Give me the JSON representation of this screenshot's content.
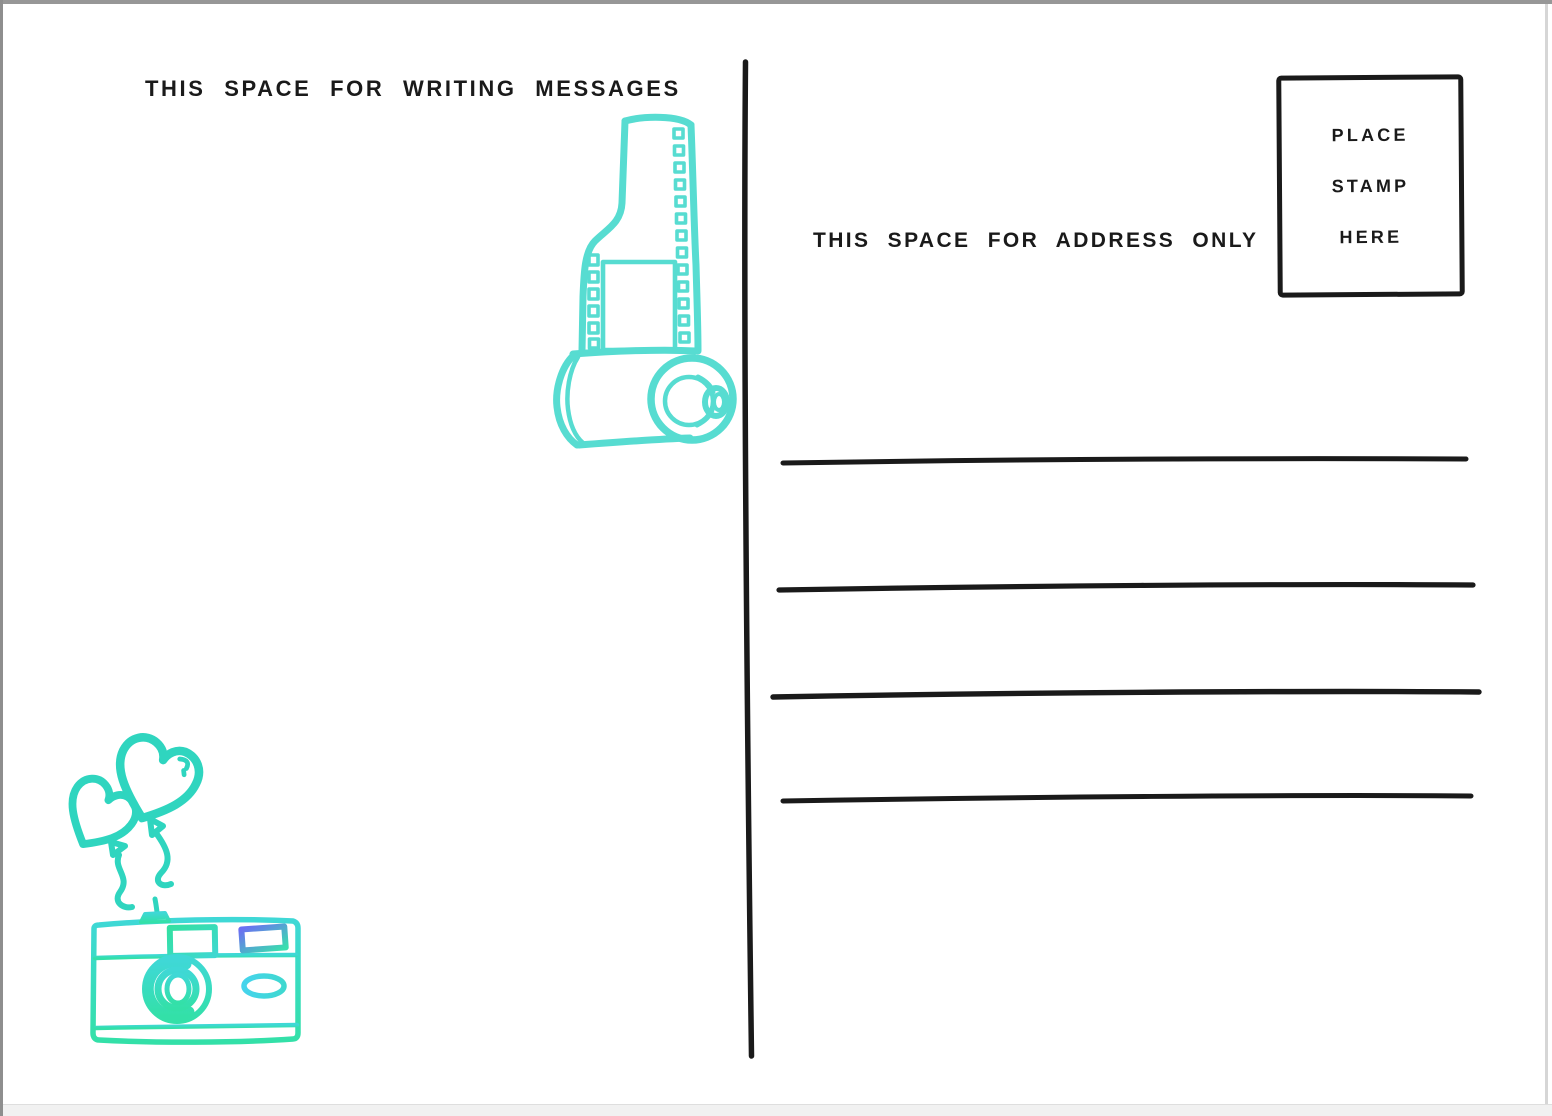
{
  "postcard": {
    "message_section": {
      "label": "THIS SPACE FOR WRITING MESSAGES"
    },
    "address_section": {
      "label": "THIS SPACE FOR ADDRESS ONLY",
      "address_lines": [
        "",
        "",
        "",
        ""
      ]
    },
    "stamp_box": {
      "lines": [
        "PLACE",
        "STAMP",
        "HERE"
      ]
    },
    "illustrations": {
      "film_roll": "hand-drawn 35mm film roll with film strip",
      "heart_balloons": "two heart-shaped balloons on strings",
      "camera": "hand-drawn point-and-shoot camera"
    },
    "colors": {
      "ink": "#1a1a1a",
      "film": "#57dcd1",
      "balloon": "#2fd5bf",
      "camera_teal": "#3fd8d6",
      "camera_green": "#33e0a8",
      "accent_blue": "#6b6ff2",
      "accent_cyan": "#45d4ec"
    }
  }
}
